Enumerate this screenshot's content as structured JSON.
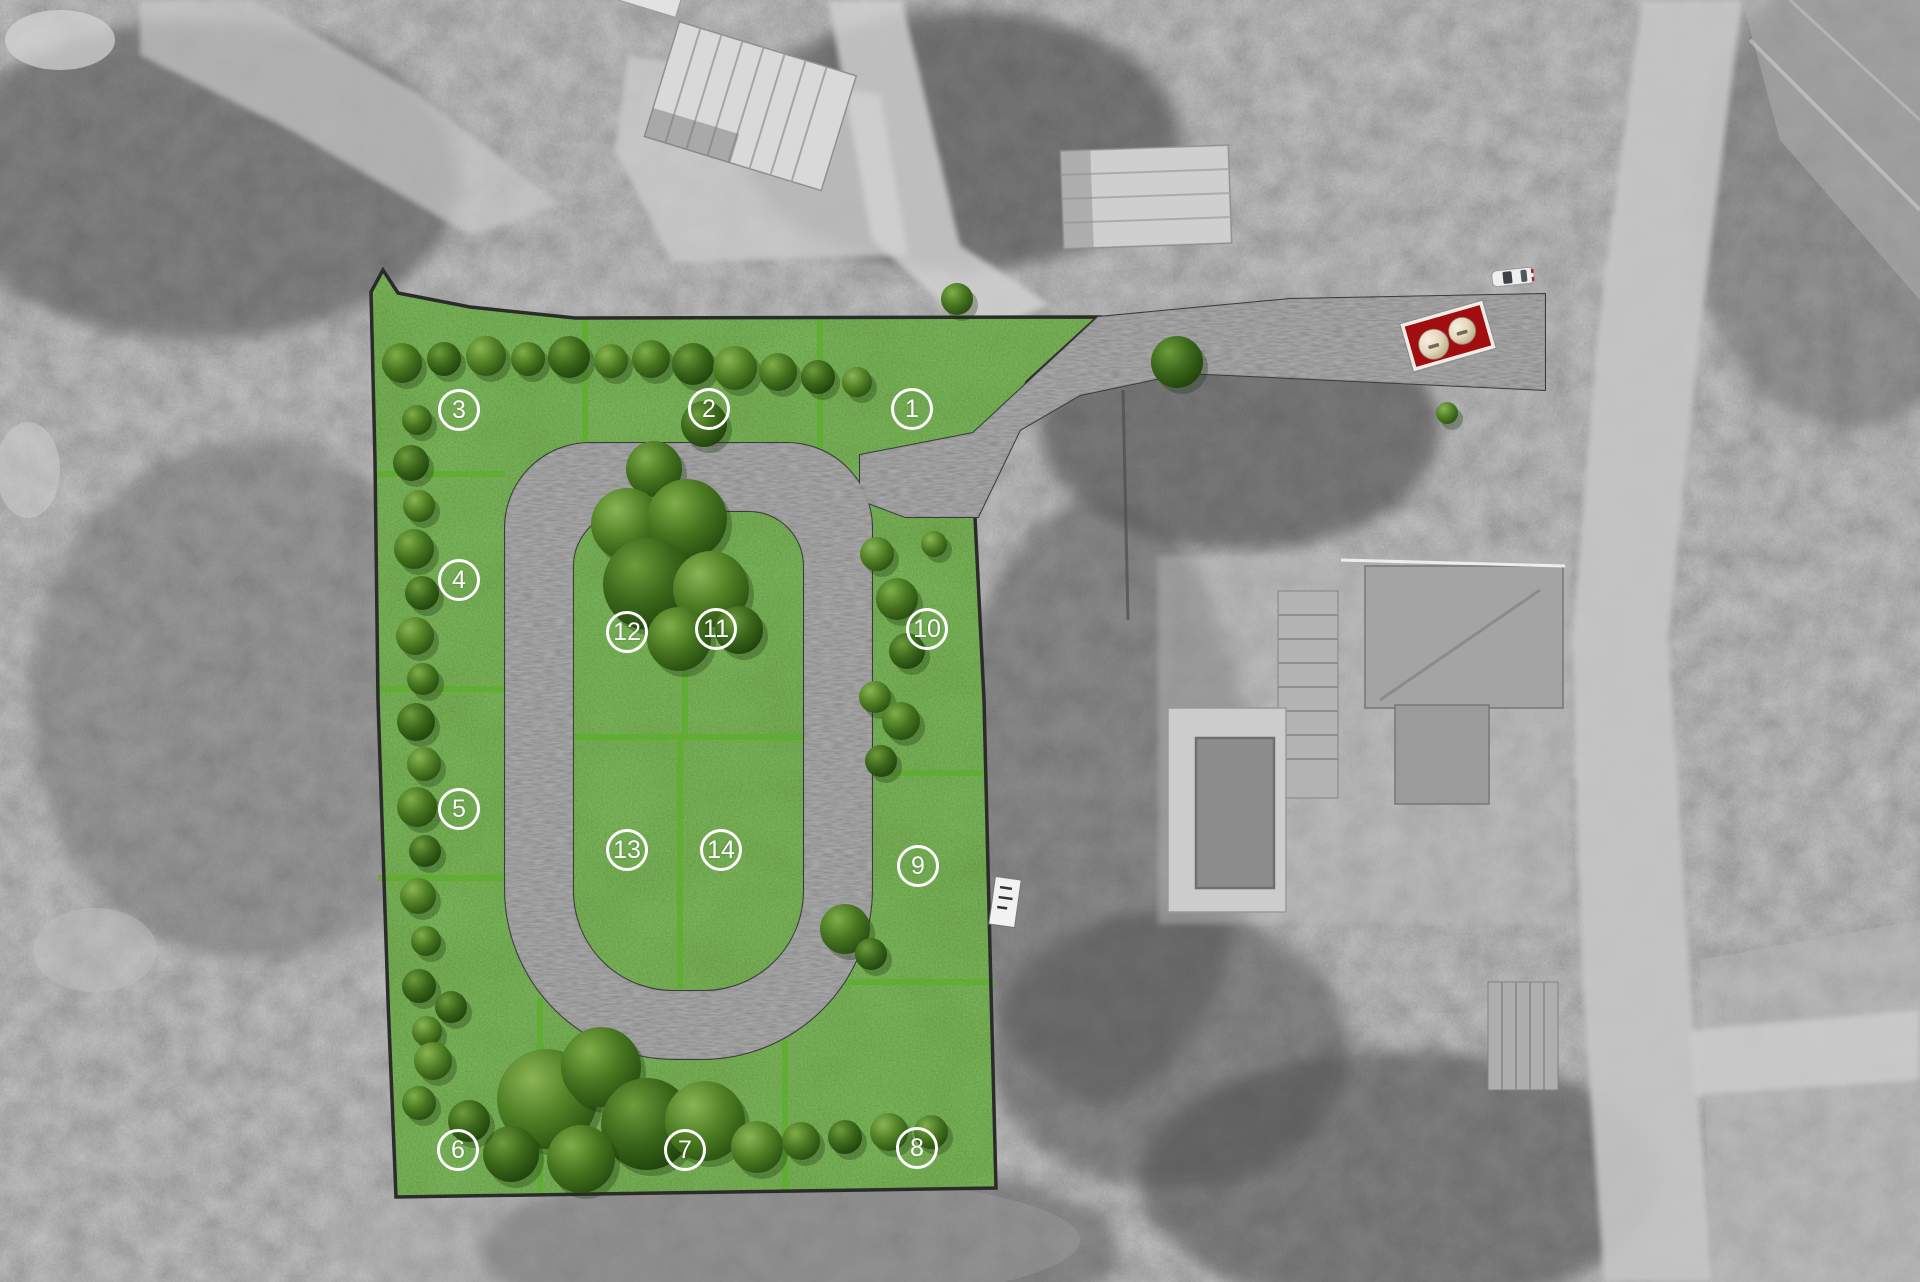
{
  "page": {
    "kind": "residential-lot-site-plan-over-grayscale-aerial-photo",
    "lot_count": 14
  },
  "colors": {
    "grass_base": "#3e7a1e",
    "divider_green": "#5fae2f",
    "road_gray": "#59595b",
    "road_border": "#3a3a3c",
    "site_border": "#2b2b2b",
    "badge_white": "#ffffff",
    "marker_red": "#a20d10",
    "marker_border": "#f0ede6",
    "tank_cream": "#ece1c8",
    "car_white": "#efefef",
    "photo_gray": "#8d8d8d",
    "pool_water": "#8d8d8d"
  },
  "lots": [
    {
      "number": "1",
      "x": 912,
      "y": 409
    },
    {
      "number": "2",
      "x": 709,
      "y": 409
    },
    {
      "number": "3",
      "x": 459,
      "y": 410
    },
    {
      "number": "4",
      "x": 459,
      "y": 580
    },
    {
      "number": "5",
      "x": 459,
      "y": 809
    },
    {
      "number": "6",
      "x": 458,
      "y": 1150
    },
    {
      "number": "7",
      "x": 685,
      "y": 1150
    },
    {
      "number": "8",
      "x": 917,
      "y": 1148
    },
    {
      "number": "9",
      "x": 918,
      "y": 866
    },
    {
      "number": "10",
      "x": 927,
      "y": 629
    },
    {
      "number": "11",
      "x": 716,
      "y": 629
    },
    {
      "number": "12",
      "x": 627,
      "y": 632
    },
    {
      "number": "13",
      "x": 627,
      "y": 850
    },
    {
      "number": "14",
      "x": 721,
      "y": 850
    }
  ],
  "entrance": {
    "panel": "red-panel-with-two-storage-tanks",
    "tanks": 2,
    "vehicle": "white-car"
  },
  "vegetation": {
    "trees": [
      {
        "x": 402,
        "y": 363,
        "r": 20
      },
      {
        "x": 444,
        "y": 359,
        "r": 17
      },
      {
        "x": 486,
        "y": 356,
        "r": 20
      },
      {
        "x": 528,
        "y": 359,
        "r": 17
      },
      {
        "x": 569,
        "y": 357,
        "r": 21
      },
      {
        "x": 611,
        "y": 361,
        "r": 17
      },
      {
        "x": 651,
        "y": 359,
        "r": 19
      },
      {
        "x": 693,
        "y": 364,
        "r": 21
      },
      {
        "x": 735,
        "y": 368,
        "r": 22
      },
      {
        "x": 778,
        "y": 372,
        "r": 19
      },
      {
        "x": 818,
        "y": 377,
        "r": 17
      },
      {
        "x": 857,
        "y": 382,
        "r": 15
      },
      {
        "x": 957,
        "y": 299,
        "r": 16
      },
      {
        "x": 1177,
        "y": 362,
        "r": 26
      },
      {
        "x": 1447,
        "y": 413,
        "r": 11
      },
      {
        "x": 417,
        "y": 420,
        "r": 15
      },
      {
        "x": 411,
        "y": 463,
        "r": 18
      },
      {
        "x": 419,
        "y": 506,
        "r": 16
      },
      {
        "x": 414,
        "y": 549,
        "r": 20
      },
      {
        "x": 422,
        "y": 593,
        "r": 17
      },
      {
        "x": 415,
        "y": 636,
        "r": 19
      },
      {
        "x": 423,
        "y": 679,
        "r": 16
      },
      {
        "x": 416,
        "y": 722,
        "r": 19
      },
      {
        "x": 424,
        "y": 764,
        "r": 17
      },
      {
        "x": 417,
        "y": 807,
        "r": 20
      },
      {
        "x": 425,
        "y": 851,
        "r": 16
      },
      {
        "x": 418,
        "y": 896,
        "r": 18
      },
      {
        "x": 426,
        "y": 941,
        "r": 15
      },
      {
        "x": 419,
        "y": 986,
        "r": 17
      },
      {
        "x": 427,
        "y": 1031,
        "r": 15
      },
      {
        "x": 654,
        "y": 469,
        "r": 28
      },
      {
        "x": 704,
        "y": 424,
        "r": 23
      },
      {
        "x": 627,
        "y": 524,
        "r": 36
      },
      {
        "x": 687,
        "y": 519,
        "r": 40
      },
      {
        "x": 649,
        "y": 584,
        "r": 46
      },
      {
        "x": 711,
        "y": 589,
        "r": 38
      },
      {
        "x": 679,
        "y": 639,
        "r": 32
      },
      {
        "x": 739,
        "y": 630,
        "r": 24
      },
      {
        "x": 877,
        "y": 554,
        "r": 17
      },
      {
        "x": 897,
        "y": 599,
        "r": 21
      },
      {
        "x": 907,
        "y": 651,
        "r": 18
      },
      {
        "x": 875,
        "y": 697,
        "r": 16
      },
      {
        "x": 901,
        "y": 721,
        "r": 19
      },
      {
        "x": 881,
        "y": 761,
        "r": 16
      },
      {
        "x": 934,
        "y": 544,
        "r": 13
      },
      {
        "x": 845,
        "y": 929,
        "r": 25
      },
      {
        "x": 871,
        "y": 954,
        "r": 16
      },
      {
        "x": 547,
        "y": 1099,
        "r": 50
      },
      {
        "x": 601,
        "y": 1067,
        "r": 40
      },
      {
        "x": 647,
        "y": 1124,
        "r": 46
      },
      {
        "x": 705,
        "y": 1121,
        "r": 40
      },
      {
        "x": 581,
        "y": 1159,
        "r": 34
      },
      {
        "x": 511,
        "y": 1154,
        "r": 28
      },
      {
        "x": 757,
        "y": 1147,
        "r": 26
      },
      {
        "x": 801,
        "y": 1141,
        "r": 19
      },
      {
        "x": 845,
        "y": 1137,
        "r": 17
      },
      {
        "x": 889,
        "y": 1132,
        "r": 19
      },
      {
        "x": 931,
        "y": 1132,
        "r": 17
      },
      {
        "x": 469,
        "y": 1121,
        "r": 21
      },
      {
        "x": 433,
        "y": 1061,
        "r": 19
      },
      {
        "x": 419,
        "y": 1103,
        "r": 17
      },
      {
        "x": 451,
        "y": 1007,
        "r": 16
      }
    ]
  }
}
